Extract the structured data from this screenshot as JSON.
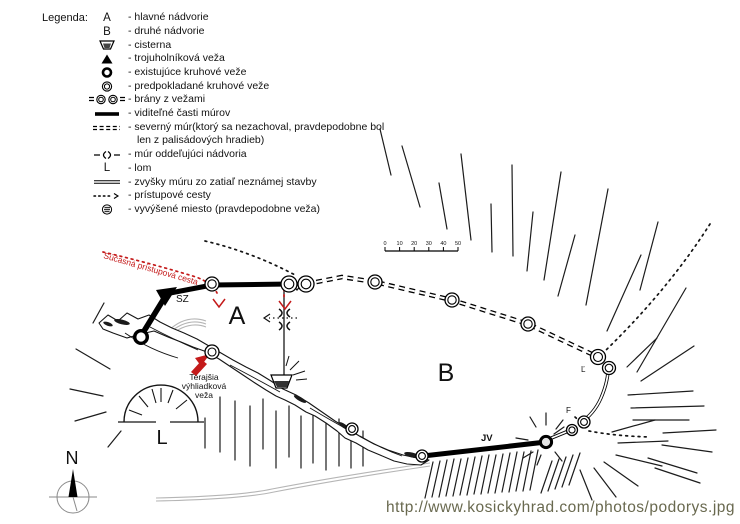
{
  "legend": {
    "heading": "Legenda:",
    "items": [
      {
        "glyph": "A",
        "label": "- hlavné nádvorie"
      },
      {
        "glyph": "B",
        "label": "- druhé nádvorie"
      },
      {
        "label": "- cisterna"
      },
      {
        "label": "- trojuholníková veža"
      },
      {
        "label": "- existujúce kruhové veže"
      },
      {
        "label": "- predpokladané kruhové veže"
      },
      {
        "label": "- brány z vežami"
      },
      {
        "label": "- viditeľné časti múrov"
      },
      {
        "label": "- severný múr(ktorý sa nezachoval, pravdepodobne bol",
        "label2": "len z palisádových hradieb)"
      },
      {
        "label": "- múr oddeľujúci nádvoria"
      },
      {
        "glyph": "L",
        "label": "- lom"
      },
      {
        "label": "- zvyšky múru zo zatiaľ neznámej stavby"
      },
      {
        "label": "- prístupové cesty"
      },
      {
        "label": "- vyvýšené miesto (pravdepodobne veža)"
      }
    ]
  },
  "map": {
    "labels": {
      "courtyard_a": "A",
      "courtyard_b": "B",
      "quarry": "L",
      "north": "N",
      "nw_corner": "SZ",
      "se_corner": "JV",
      "east_point": "Ľ",
      "f_point": "F",
      "current_access_road": "Súčasná prístupová cesta",
      "lookout_line1": "Terajšia",
      "lookout_line2": "výhliadková",
      "lookout_line3": "veža"
    },
    "scale": {
      "ticks": [
        "0",
        "10",
        "20",
        "30",
        "40",
        "50"
      ]
    }
  },
  "footer": {
    "url": "http://www.kosickyhrad.com/photos/podorys.jpg"
  },
  "colors": {
    "ink": "#141414",
    "red": "#c41a1a",
    "gray_path": "#b5b5b5",
    "url_text": "#69694f"
  }
}
